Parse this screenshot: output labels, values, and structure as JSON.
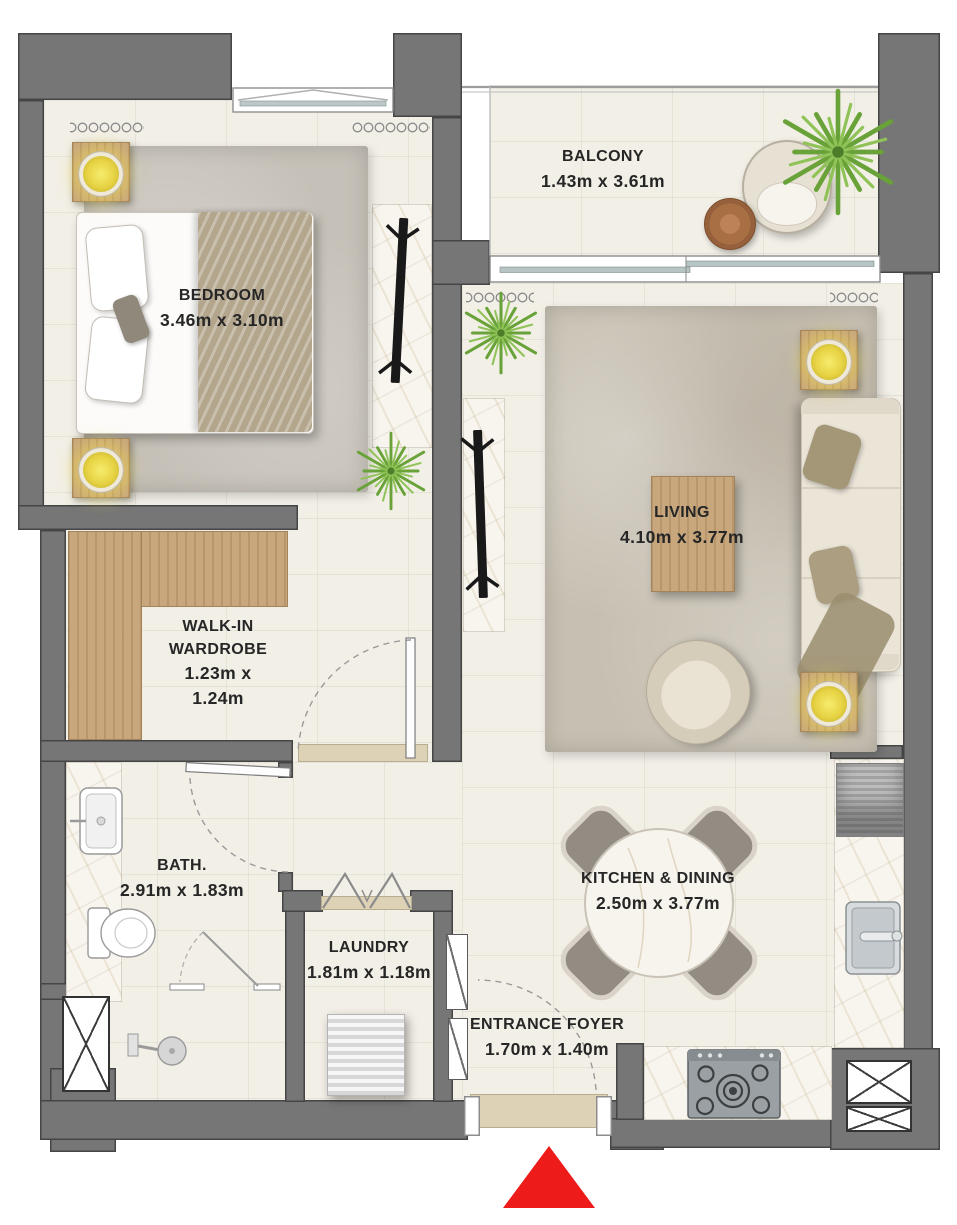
{
  "rooms": {
    "balcony": {
      "name": "BALCONY",
      "dims": "1.43m x 3.61m"
    },
    "bedroom": {
      "name": "BEDROOM",
      "dims": "3.46m x 3.10m"
    },
    "living": {
      "name": "LIVING",
      "dims": "4.10m x 3.77m"
    },
    "wardrobe": {
      "name_line1": "WALK-IN",
      "name_line2": "WARDROBE",
      "dims_line1": "1.23m x",
      "dims_line2": "1.24m"
    },
    "bath": {
      "name": "BATH.",
      "dims": "2.91m x 1.83m"
    },
    "laundry": {
      "name": "LAUNDRY",
      "dims": "1.81m x 1.18m"
    },
    "kitchen": {
      "name": "KITCHEN & DINING",
      "dims": "2.50m x 3.77m"
    },
    "foyer": {
      "name": "ENTRANCE FOYER",
      "dims": "1.70m x 1.40m"
    }
  },
  "symbols": {
    "entrance_marker": "red-triangle"
  },
  "colors": {
    "wall": "#767676",
    "wall_outline": "#454545",
    "floor_tile": "#f2efe7",
    "marble": "#f8f5ee",
    "wood": "#c8a77d",
    "rug": "#cac4b8",
    "accent_red": "#ee1b1b",
    "lamp_glow": "#eedc50",
    "plant_green": "#7cb342"
  }
}
